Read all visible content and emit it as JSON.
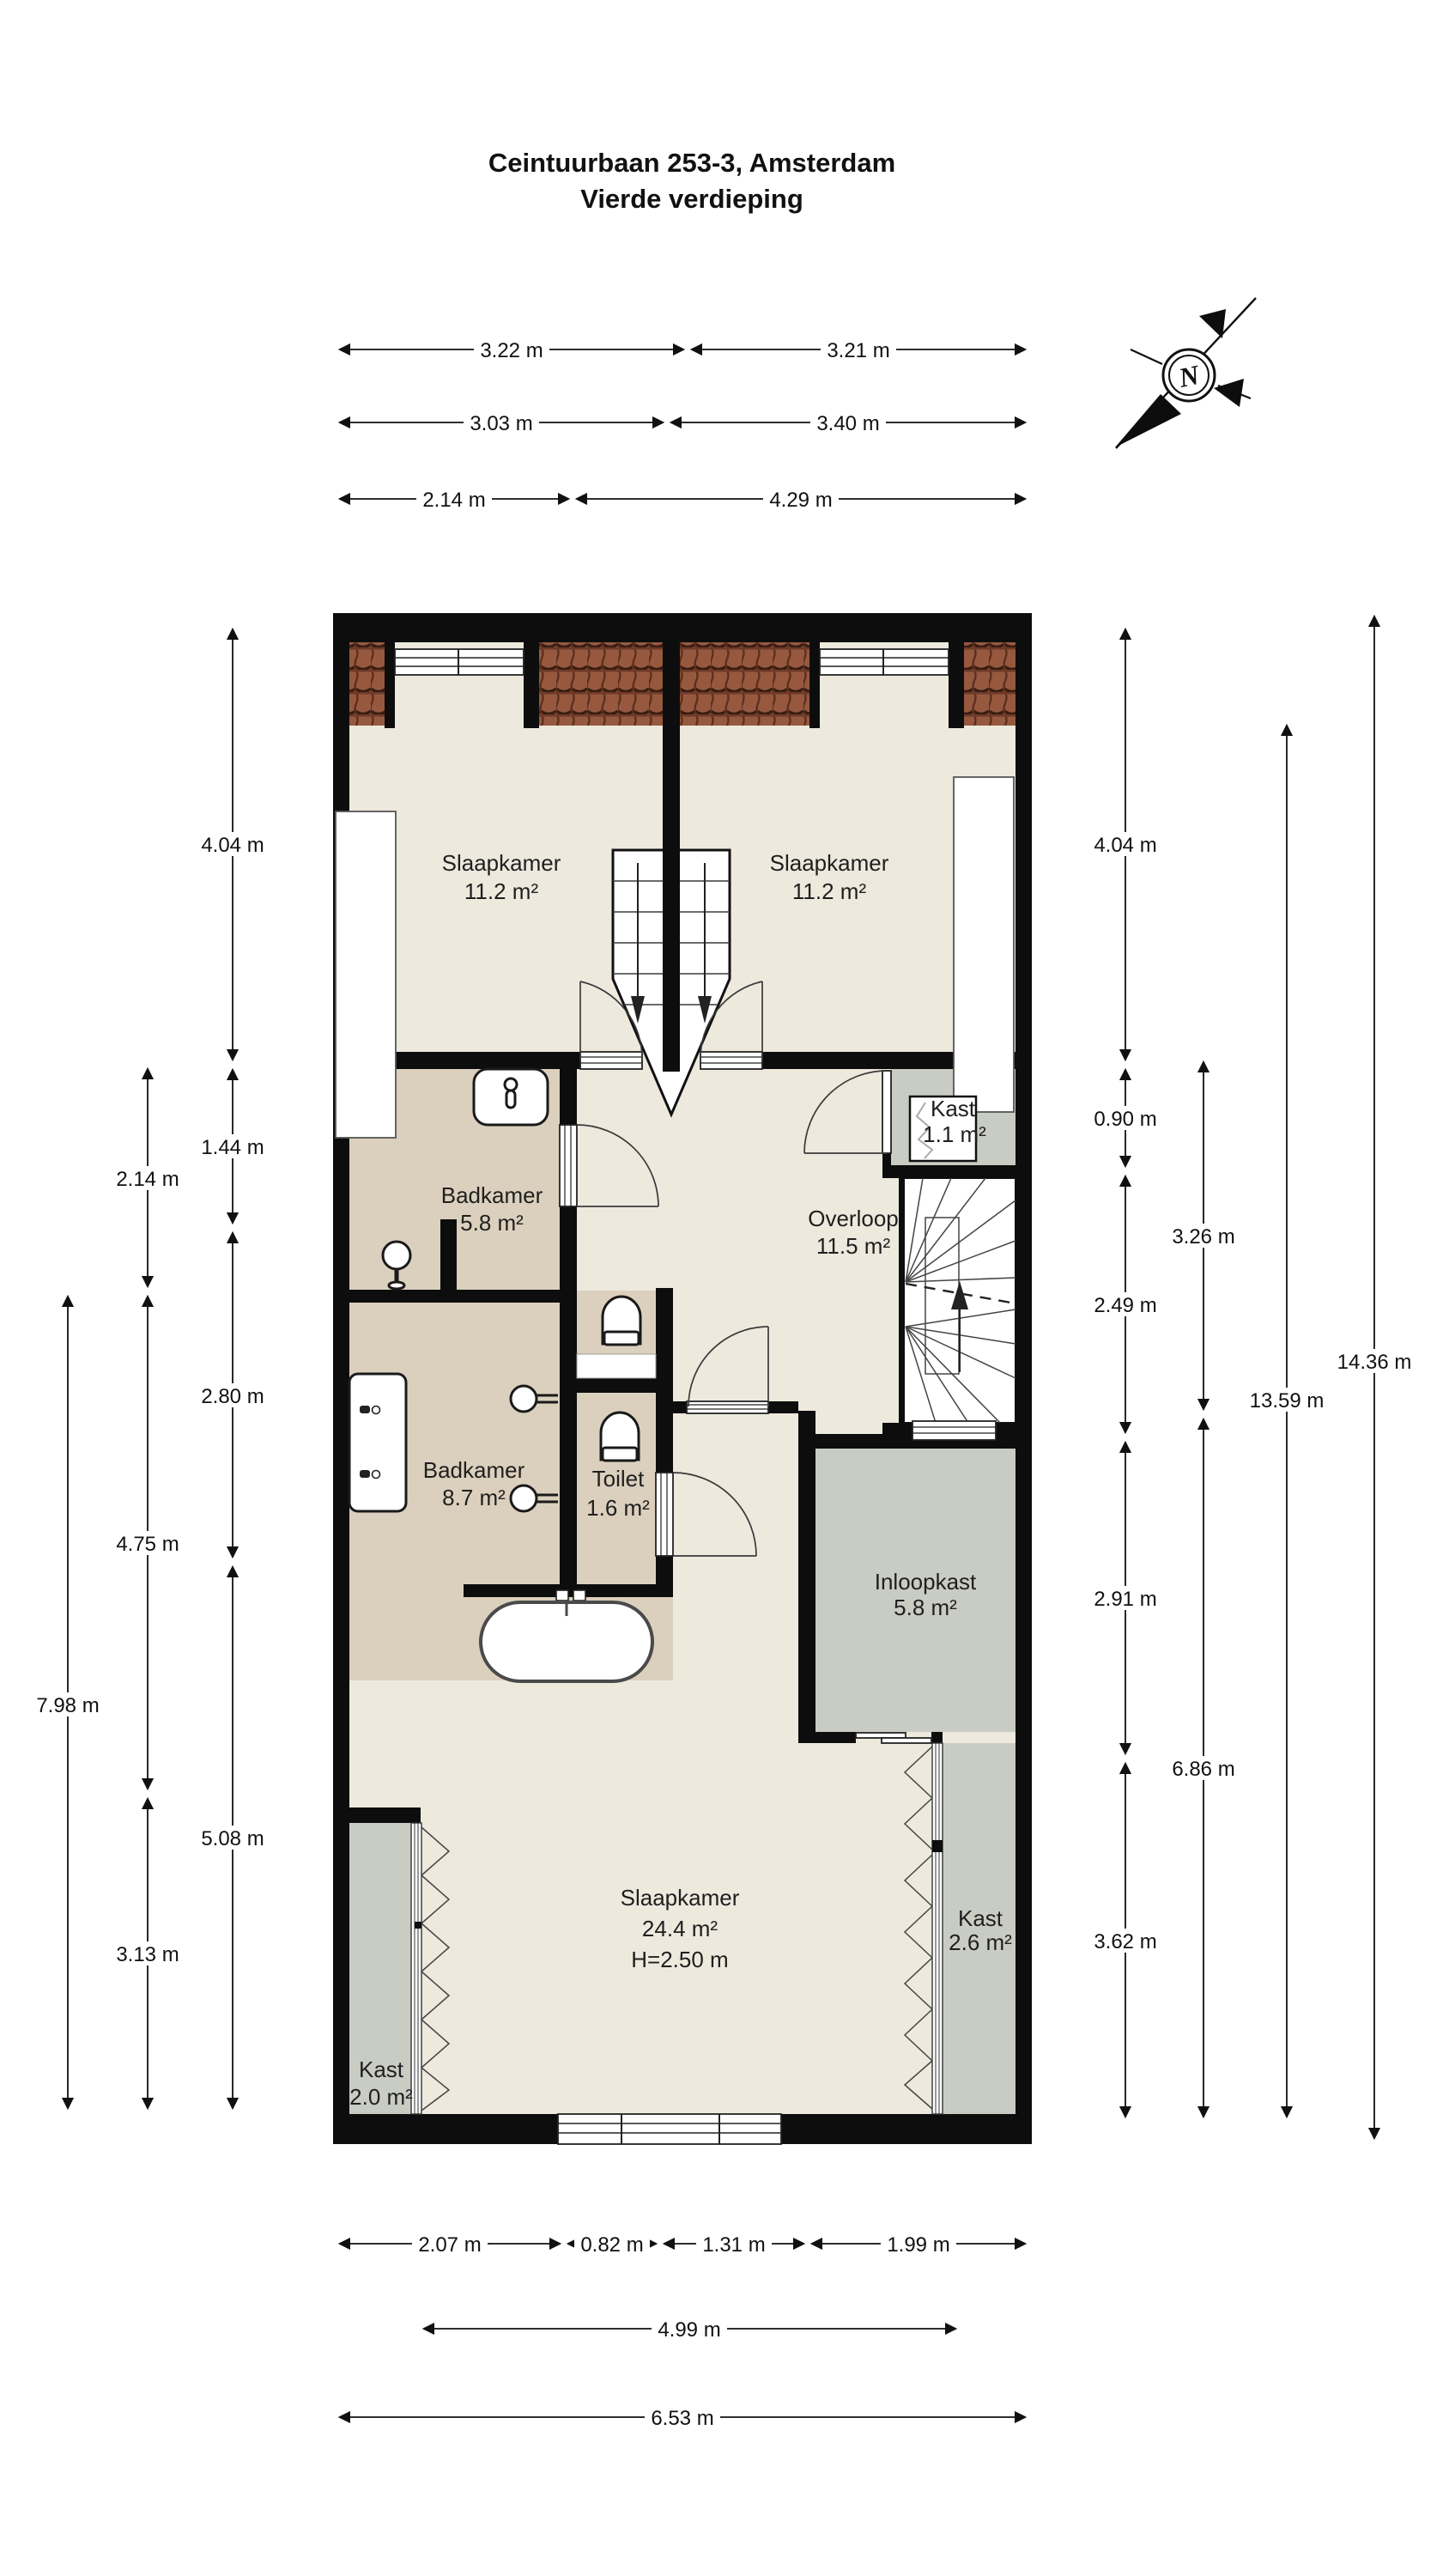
{
  "title": {
    "line1": "Ceintuurbaan 253-3, Amsterdam",
    "line2": "Vierde verdieping"
  },
  "compass": {
    "north_label": "N"
  },
  "rooms": {
    "slaapkamer_links": {
      "name": "Slaapkamer",
      "area": "11.2 m²"
    },
    "slaapkamer_rechts": {
      "name": "Slaapkamer",
      "area": "11.2 m²"
    },
    "badkamer_klein": {
      "name": "Badkamer",
      "area": "5.8 m²"
    },
    "overloop": {
      "name": "Overloop",
      "area": "11.5 m²"
    },
    "kast_klein": {
      "name": "Kast",
      "area": "1.1 m²"
    },
    "badkamer_groot": {
      "name": "Badkamer",
      "area": "8.7 m²"
    },
    "toilet": {
      "name": "Toilet",
      "area": "1.6 m²"
    },
    "inloopkast": {
      "name": "Inloopkast",
      "area": "5.8 m²"
    },
    "slaapkamer_groot": {
      "name": "Slaapkamer",
      "area": "24.4 m²",
      "height": "H=2.50 m"
    },
    "kast_links": {
      "name": "Kast",
      "area": "2.0 m²"
    },
    "kast_rechts": {
      "name": "Kast",
      "area": "2.6 m²"
    }
  },
  "dims": {
    "top": [
      "3.22 m",
      "3.21 m",
      "3.03 m",
      "3.40 m",
      "2.14 m",
      "4.29 m"
    ],
    "bottom": [
      "2.07 m",
      "0.82 m",
      "1.31 m",
      "1.99 m",
      "4.99 m",
      "6.53 m"
    ],
    "left": [
      "4.04 m",
      "1.44 m",
      "2.80 m",
      "5.08 m",
      "2.14 m",
      "4.75 m",
      "3.13 m",
      "7.98 m"
    ],
    "right": [
      "4.04 m",
      "0.90 m",
      "2.49 m",
      "2.91 m",
      "3.62 m",
      "3.26 m",
      "6.86 m",
      "13.59 m",
      "14.36 m"
    ]
  },
  "colors": {
    "floor": "#EDE9DD",
    "wet": "#DBD0BD",
    "closet": "#C9CCC3",
    "stairs": "#FFFFFF",
    "wall": "#0D0D0D",
    "tile": "#96593F",
    "tile_dark": "#5E2F1F"
  }
}
